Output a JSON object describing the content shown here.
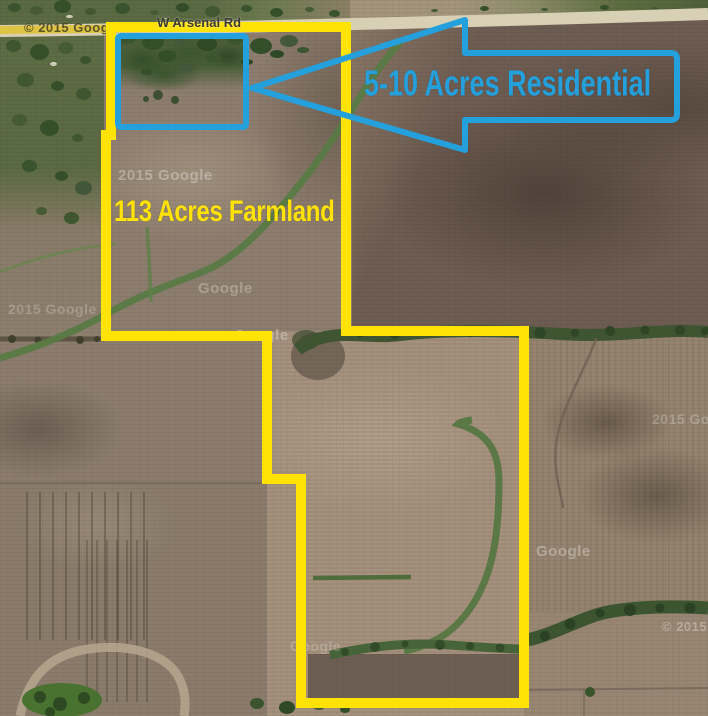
{
  "map": {
    "road": {
      "label": "W Arsenal Rd"
    },
    "annotations": {
      "farmland": {
        "label": "113 Acres Farmland",
        "outline_color": "#FFE206"
      },
      "residential": {
        "label": "5-10 Acres Residential",
        "outline_color": "#24A0DC"
      }
    },
    "watermarks": [
      {
        "text": "© 2015 Google"
      },
      {
        "text": "2015 Google"
      },
      {
        "text": "Google"
      },
      {
        "text": "2015 Google"
      },
      {
        "text": "Google"
      },
      {
        "text": "Google"
      },
      {
        "text": "2015 Google"
      },
      {
        "text": "© 2015 Google"
      },
      {
        "text": "Google"
      }
    ]
  }
}
